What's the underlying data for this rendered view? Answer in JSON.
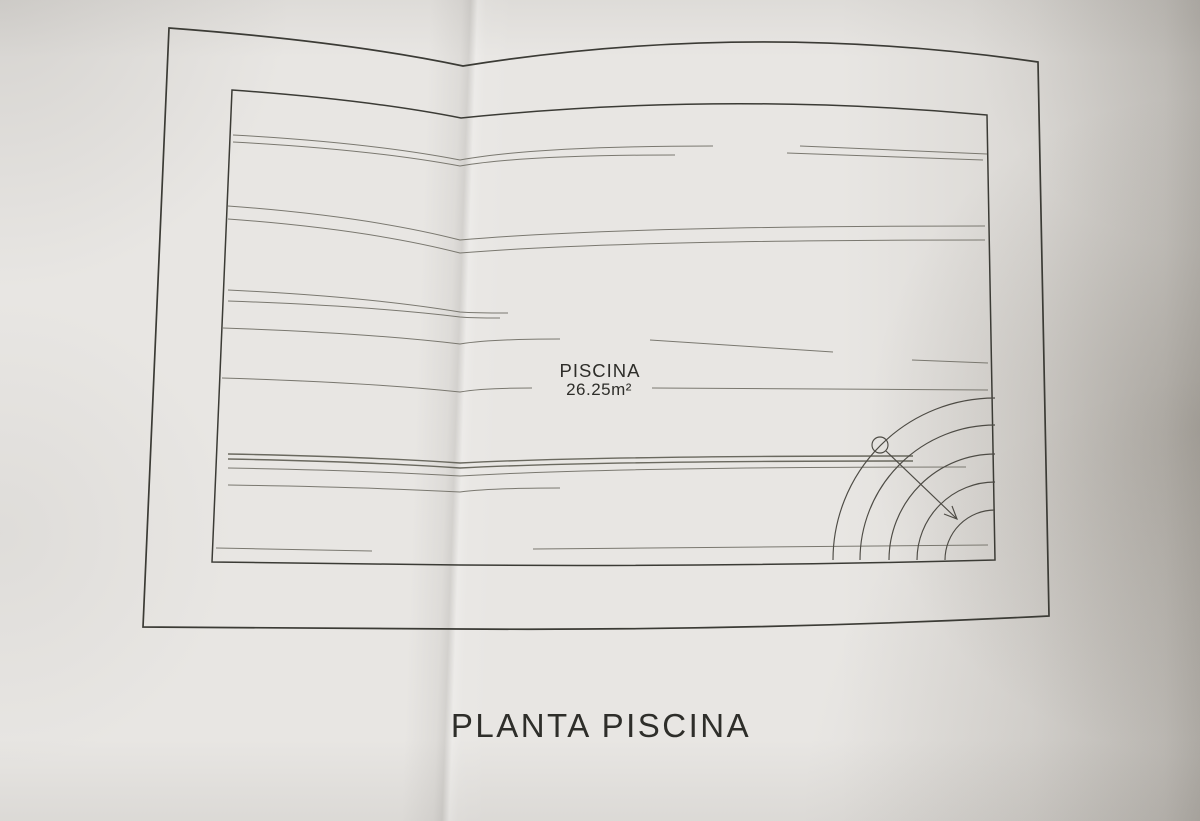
{
  "photo": {
    "paper_color": "#e8e6e3",
    "shadow_color": "#8e8880",
    "fold_x": 460
  },
  "plan": {
    "pool_label": "PISCINA",
    "pool_area": "26.25m²",
    "caption": "PLANTA PISCINA",
    "colors": {
      "border": "#3b3a35",
      "ripple": "#7a786f",
      "ripple_dark": "#6b695f",
      "arc": "#4d4b44",
      "text": "#2e2d29"
    },
    "outer_border": {
      "tl": [
        169,
        28
      ],
      "fold_top": [
        463,
        66
      ],
      "tr": [
        1038,
        62
      ],
      "br": [
        1049,
        616
      ],
      "fold_bottom": [
        460,
        629
      ],
      "bl": [
        143,
        627
      ],
      "top_bulge": 42,
      "bottom_sag": 2
    },
    "inner_border": {
      "tl": [
        232,
        90
      ],
      "fold_top": [
        461,
        118
      ],
      "tr": [
        987,
        115
      ],
      "br": [
        995,
        560
      ],
      "fold_bottom": [
        460,
        565
      ],
      "bl": [
        212,
        562
      ],
      "top_bulge": 24,
      "bottom_sag": 2
    },
    "ripples": [
      {
        "x1": 233,
        "y1": 135,
        "xf": 460,
        "yf": 160,
        "x2": 713,
        "y2": 146
      },
      {
        "x1": 800,
        "y1": 146,
        "x2": 987,
        "y2": 154
      },
      {
        "x1": 233,
        "y1": 142,
        "xf": 460,
        "yf": 166,
        "x2": 675,
        "y2": 155
      },
      {
        "x1": 787,
        "y1": 153,
        "x2": 983,
        "y2": 160
      },
      {
        "x1": 228,
        "y1": 206,
        "xf": 460,
        "yf": 240,
        "x2": 985,
        "y2": 226
      },
      {
        "x1": 228,
        "y1": 219,
        "xf": 460,
        "yf": 253,
        "x2": 985,
        "y2": 240
      },
      {
        "x1": 228,
        "y1": 290,
        "xf": 460,
        "yf": 312,
        "x2": 508,
        "y2": 313
      },
      {
        "x1": 228,
        "y1": 301,
        "xf": 460,
        "yf": 317,
        "x2": 500,
        "y2": 318
      },
      {
        "x1": 223,
        "y1": 328,
        "xf": 460,
        "yf": 344,
        "x2": 560,
        "y2": 339
      },
      {
        "x1": 650,
        "y1": 340,
        "x2": 833,
        "y2": 352
      },
      {
        "x1": 912,
        "y1": 360,
        "x2": 988,
        "y2": 363
      },
      {
        "x1": 222,
        "y1": 378,
        "xf": 460,
        "yf": 392,
        "x2": 532,
        "y2": 388
      },
      {
        "x1": 652,
        "y1": 388,
        "x2": 988,
        "y2": 390
      },
      {
        "x1": 228,
        "y1": 454,
        "xf": 460,
        "yf": 463,
        "x2": 913,
        "y2": 456,
        "dark": true
      },
      {
        "x1": 228,
        "y1": 459,
        "xf": 460,
        "yf": 468,
        "x2": 913,
        "y2": 461,
        "dark": true
      },
      {
        "x1": 228,
        "y1": 468,
        "xf": 460,
        "yf": 476,
        "x2": 966,
        "y2": 467
      },
      {
        "x1": 228,
        "y1": 485,
        "xf": 460,
        "yf": 492,
        "x2": 560,
        "y2": 488
      },
      {
        "x1": 216,
        "y1": 548,
        "x2": 372,
        "y2": 551
      },
      {
        "x1": 533,
        "y1": 549,
        "x2": 988,
        "y2": 545
      }
    ],
    "stairs": {
      "center": [
        995,
        560
      ],
      "radii": [
        162,
        135,
        106,
        78,
        50
      ]
    },
    "marker_circle": {
      "cx": 880,
      "cy": 445,
      "r": 8
    },
    "arrow": {
      "from": [
        886,
        451
      ],
      "to": [
        957,
        519
      ],
      "barb1": [
        952,
        506
      ],
      "barb2": [
        944,
        514
      ]
    }
  }
}
